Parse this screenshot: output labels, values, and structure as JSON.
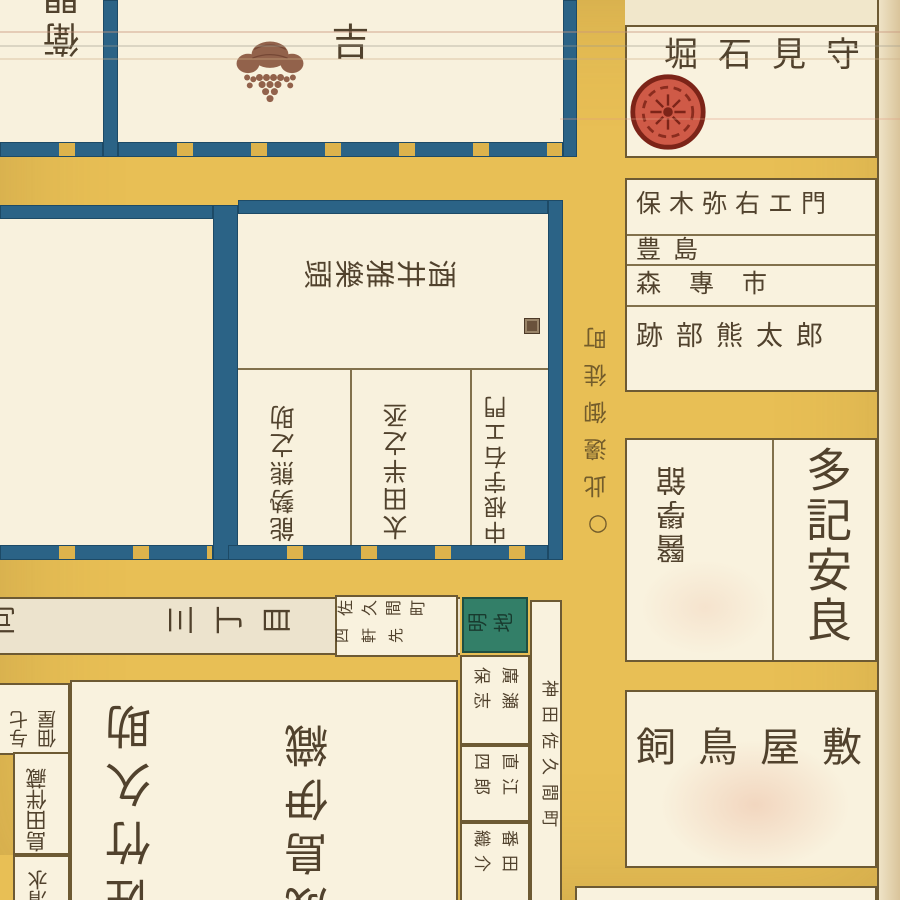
{
  "title": "江戸切絵図(部分) 下谷御徒町周辺",
  "palette": {
    "road": "#e8bf55",
    "paper": "#f8f1dd",
    "blue_border": "#2b6386",
    "green_akichi": "#337f68",
    "red_crest": "#cf5a47",
    "brown_crest": "#8a563f",
    "ink": "#46361f"
  },
  "top": {
    "left_partial_name": "衛門",
    "center_char": "吉",
    "center_crest": "paulownia-crest",
    "right_name": "堀石見守",
    "right_crest": "plum-crest"
  },
  "middle": {
    "estate_name": "酒井雅樂頭",
    "plots": [
      "能勢熊之助",
      "太田半之丞",
      "中根宇右エ門"
    ],
    "street_note": "○此邊御徒町"
  },
  "right_column": {
    "residents": [
      "保木弥右エ門",
      "豊島",
      "森專市",
      "跡部熊太郎"
    ],
    "igakukan": "醫學舘",
    "taki": "多記安良",
    "kaitori": "飼鳥屋敷"
  },
  "bottom": {
    "street_prev": "同",
    "street_chome": "三丁目",
    "sakuma_line1": "佐久間町",
    "sakuma_line2": "四軒先",
    "akichi": "明地",
    "small_plots": [
      [
        "廣瀬",
        "保志"
      ],
      [
        "直江",
        "四郎"
      ],
      [
        "番田",
        "織介"
      ]
    ],
    "kanda_street": "神田佐久間町",
    "left_boxes": {
      "a1": "佃屋",
      "a2": "与七",
      "b": "島田伴藏",
      "c": "清水"
    },
    "big_names": [
      "佐竹久助",
      "成島伊織"
    ]
  }
}
